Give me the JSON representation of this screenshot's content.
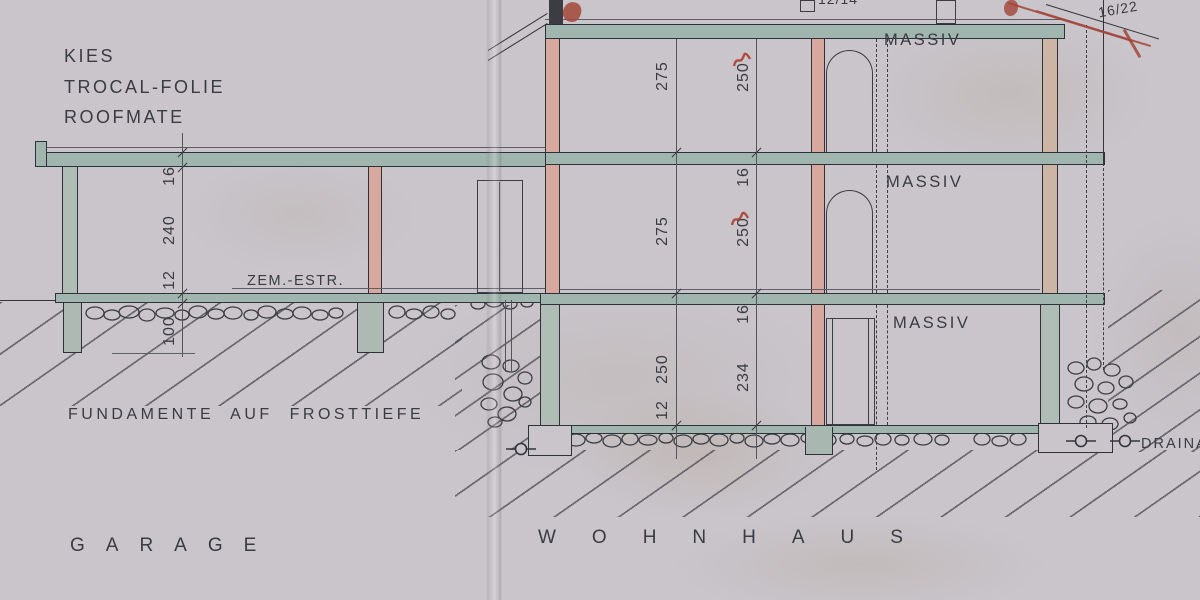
{
  "labels": {
    "material_1": "KIES",
    "material_2": "TROCAL-FOLIE",
    "material_3": "ROOFMATE",
    "screed": "ZEM.-ESTR.",
    "foundation_note": "FUNDAMENTE AUF FROSTTIEFE",
    "zone_garage": "GARAGE",
    "zone_house": "WOHNHAUS",
    "massiv_og": "MASSIV",
    "massiv_eg": "MASSIV",
    "massiv_kg": "MASSIV",
    "drainage": "DRAINA",
    "timber_mid": "12/14",
    "timber_right": "16/22"
  },
  "dims": {
    "garage": {
      "slab": "16",
      "room": "240",
      "floor": "12",
      "foundation": "100"
    },
    "left": {
      "og": "275",
      "eg": "275",
      "kg": "250",
      "kg_floor": "12"
    },
    "right": {
      "og": "250",
      "slab1": "16",
      "eg": "250",
      "slab2": "16",
      "kg": "234"
    }
  },
  "colors": {
    "paper": "#c9c5cb",
    "slab_teal": "#9fb5ad",
    "wall_brick": "#d7a89e",
    "wall_concrete": "#b0bcb6",
    "ink": "#33343c",
    "red_mark": "#a24538"
  }
}
